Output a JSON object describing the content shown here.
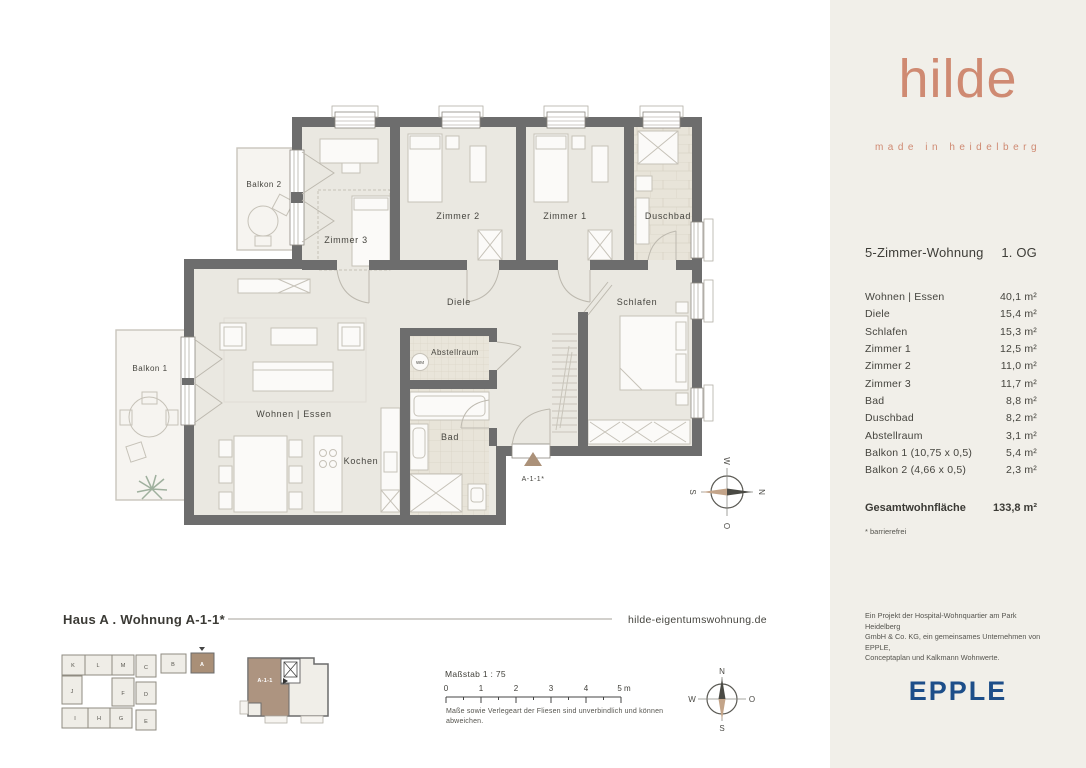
{
  "brand": {
    "logo_text": "hilde",
    "tagline": "made in heidelberg",
    "accent_color": "#cf8a72"
  },
  "unit": {
    "type_label": "5-Zimmer-Wohnung",
    "floor_label": "1. OG",
    "rooms": [
      {
        "label": "Wohnen | Essen",
        "area": "40,1 m²"
      },
      {
        "label": "Diele",
        "area": "15,4 m²"
      },
      {
        "label": "Schlafen",
        "area": "15,3 m²"
      },
      {
        "label": "Zimmer 1",
        "area": "12,5 m²"
      },
      {
        "label": "Zimmer 2",
        "area": "11,0 m²"
      },
      {
        "label": "Zimmer 3",
        "area": "11,7 m²"
      },
      {
        "label": "Bad",
        "area": "8,8 m²"
      },
      {
        "label": "Duschbad",
        "area": "8,2 m²"
      },
      {
        "label": "Abstellraum",
        "area": "3,1 m²"
      },
      {
        "label": "Balkon 1 (10,75 x 0,5)",
        "area": "5,4 m²"
      },
      {
        "label": "Balkon 2 (4,66 x 0,5)",
        "area": "2,3 m²"
      }
    ],
    "total_label": "Gesamtwohnfläche",
    "total_area": "133,8 m²",
    "footnote": "* barrierefrei"
  },
  "plan": {
    "labels": {
      "balkon2": "Balkon 2",
      "zimmer3": "Zimmer 3",
      "zimmer2": "Zimmer 2",
      "zimmer1": "Zimmer 1",
      "duschbad": "Duschbad",
      "diele": "Diele",
      "schlafen": "Schlafen",
      "abstellraum": "Abstellraum",
      "bad": "Bad",
      "wohnen_essen": "Wohnen | Essen",
      "kochen": "Kochen",
      "balkon1": "Balkon 1",
      "entry_marker": "A-1-1*",
      "washer": "WM"
    },
    "wall_color": "#6d6d6d",
    "floor_color": "#eae8e1",
    "marker_color": "#ab9179"
  },
  "compass": {
    "north": "N",
    "east": "O",
    "south": "S",
    "west": "W"
  },
  "footer": {
    "plan_title": "Haus A . Wohnung A-1-1*",
    "website": "hilde-eigentumswohnung.de",
    "scale_label": "Maßstab 1 : 75",
    "scale_ticks": [
      "0",
      "1",
      "2",
      "3",
      "4",
      "5 m"
    ],
    "disclaimer_line1": "Maße sowie Verlegeart der Fliesen sind unverbindlich und können",
    "disclaimer_line2": "abweichen.",
    "site_buildings": [
      "K",
      "L",
      "M",
      "J",
      "F",
      "I",
      "H",
      "G",
      "C",
      "D",
      "E",
      "B",
      "A"
    ],
    "unit_key": "A-1-1"
  },
  "legal": {
    "project_line1": "Ein Projekt der Hospital-Wohnquartier am Park Heidelberg",
    "project_line2": "GmbH & Co. KG, ein gemeinsames Unternehmen von EPPLE,",
    "project_line3": "Conceptaplan und Kalkmann Wohnwerte.",
    "developer": "EPPLE",
    "developer_color": "#1d4e89"
  }
}
